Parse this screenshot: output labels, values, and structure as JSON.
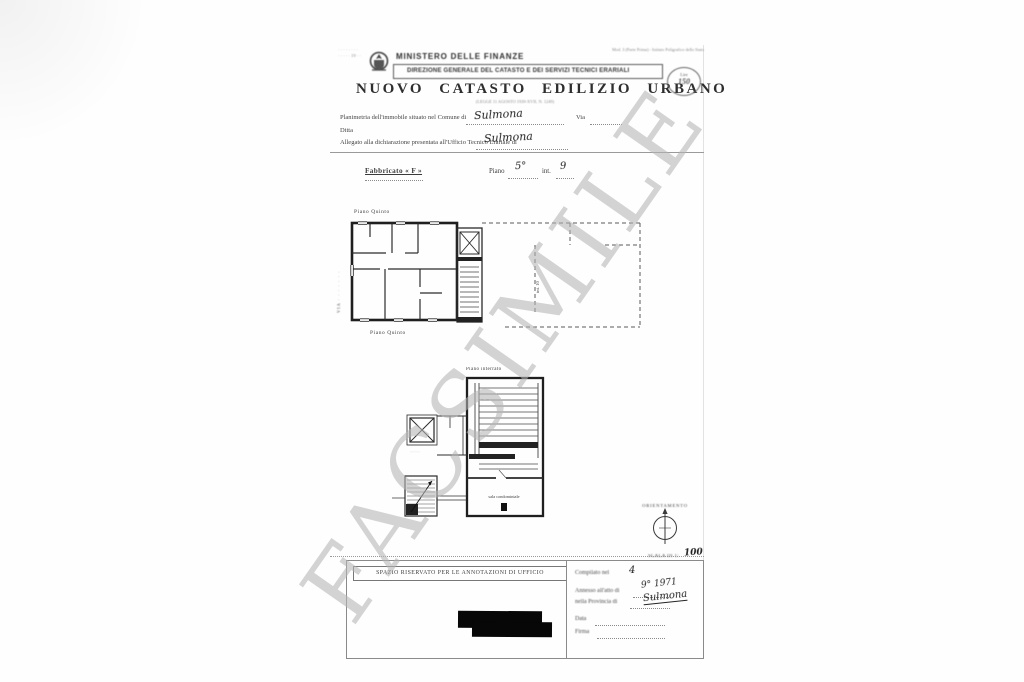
{
  "watermark_text": "FACSIMILE",
  "header": {
    "corner_stamp_line1": "· · · · · · · ·",
    "corner_stamp_line2": "· · · · · 19 · ·",
    "mod_note": "Mod. 3 (Parte Prima) - Istituto Poligrafico dello Stato",
    "ministry": "MINISTERO DELLE FINANZE",
    "direction": "DIREZIONE GENERALE DEL CATASTO E DEI SERVIZI TECNICI ERARIALI",
    "title": "NUOVO CATASTO EDILIZIO URBANO",
    "subtitle": "(LEGGE 11 AGOSTO 1939-XVII, N. 1249)",
    "stamp_lire_label": "Lire",
    "stamp_lire_value": "150"
  },
  "form": {
    "line1_label": "Planimetria dell'immobile situato nel Comune di",
    "line1_value": "Sulmona",
    "line1_suffix": "Via",
    "line2_label": "Ditta",
    "line3_label": "Allegato alla dichiarazione presentata all'Ufficio Tecnico Erariale di",
    "line3_value": "Sulmona"
  },
  "section": {
    "fabbricato": "Fabbricato « F »",
    "piano_label": "Piano",
    "piano_value": "5°",
    "interno_label": "int.",
    "interno_value": "9"
  },
  "plans": {
    "upper": {
      "label_top": "Piano Quinto",
      "label_bottom": "Piano Quinto",
      "street_label": "VIA · · · · · · ·",
      "adjacent_note": "int. 10"
    },
    "lower": {
      "label_top": "Piano interrato",
      "room_label": "sala condominiale",
      "stair_note": "· · · · ·"
    }
  },
  "orientation": {
    "title": "ORIENTAMENTO",
    "scale_label": "SCALA DI 1:",
    "scale_value": "100"
  },
  "footer": {
    "box_title": "SPAZIO RISERVATO PER LE ANNOTAZIONI DI UFFICIO",
    "compilato_label": "Compilato nel",
    "compilato_value": "4",
    "annesso_label": "Annesso all'atto di",
    "annesso_value": "9° 1971",
    "provincia_label": "nella Provincia di",
    "provincia_value": "Sulmona",
    "data_label": "Data",
    "firma_label": "Firma"
  }
}
